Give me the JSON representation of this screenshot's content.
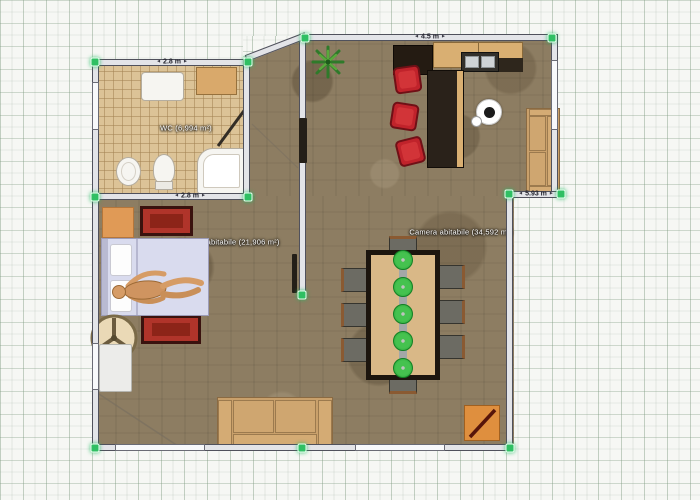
{
  "editor": {
    "type": "floor-plan-canvas",
    "language": "it"
  },
  "rooms": [
    {
      "name": "wc",
      "label": "WC (6,994 m²)"
    },
    {
      "name": "bedroom",
      "label": "Camera abitabile (21,906 m²)"
    },
    {
      "name": "living-room",
      "label": "Camera abitabile (34,592 m²)"
    }
  ],
  "measurements": {
    "wc_top": "2.8 m",
    "wc_bottom": "2.8 m",
    "top_wall": "4.5 m",
    "right_step": "5.93 m"
  },
  "colors": {
    "selection_handle": "#2fbf63",
    "wall_fill": "#e3e4e8",
    "wall_edge": "#50515c",
    "wood_floor": "#8d7d62",
    "tile_floor": "#dcc397",
    "stool_red": "#c0232b",
    "plate_green": "#2eae3c",
    "rug_red": "#b0342a",
    "sofa_tan": "#c9a06b"
  },
  "furniture_icons": [
    "bathtub",
    "toilet",
    "bidet",
    "bathroom-cabinet",
    "washbasin",
    "bed",
    "mannequin",
    "dresser",
    "red-rug-top",
    "red-rug-bottom",
    "round-wheel-table",
    "wardrobe",
    "bottom-sofa",
    "right-sofa",
    "dining-table",
    "dining-chair",
    "green-plate",
    "bar-stool",
    "kitchen-cabinet",
    "kitchen-sink",
    "kitchen-island",
    "plant",
    "decor-plate",
    "corner-unit"
  ]
}
